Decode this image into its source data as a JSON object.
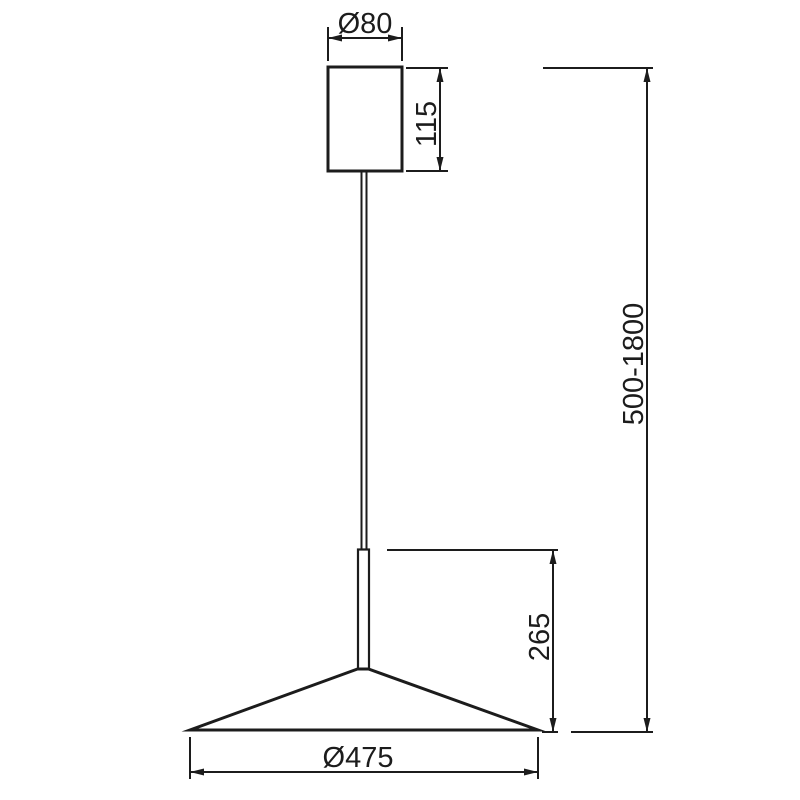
{
  "drawing": {
    "type": "pendant-lamp-dimension-drawing",
    "labels": {
      "canopy_diameter": "Ø80",
      "canopy_height": "115",
      "suspension_range": "500-1800",
      "body_height": "265",
      "shade_diameter": "Ø475"
    },
    "colors": {
      "line": "#1c1c1c",
      "background": "#ffffff"
    }
  }
}
